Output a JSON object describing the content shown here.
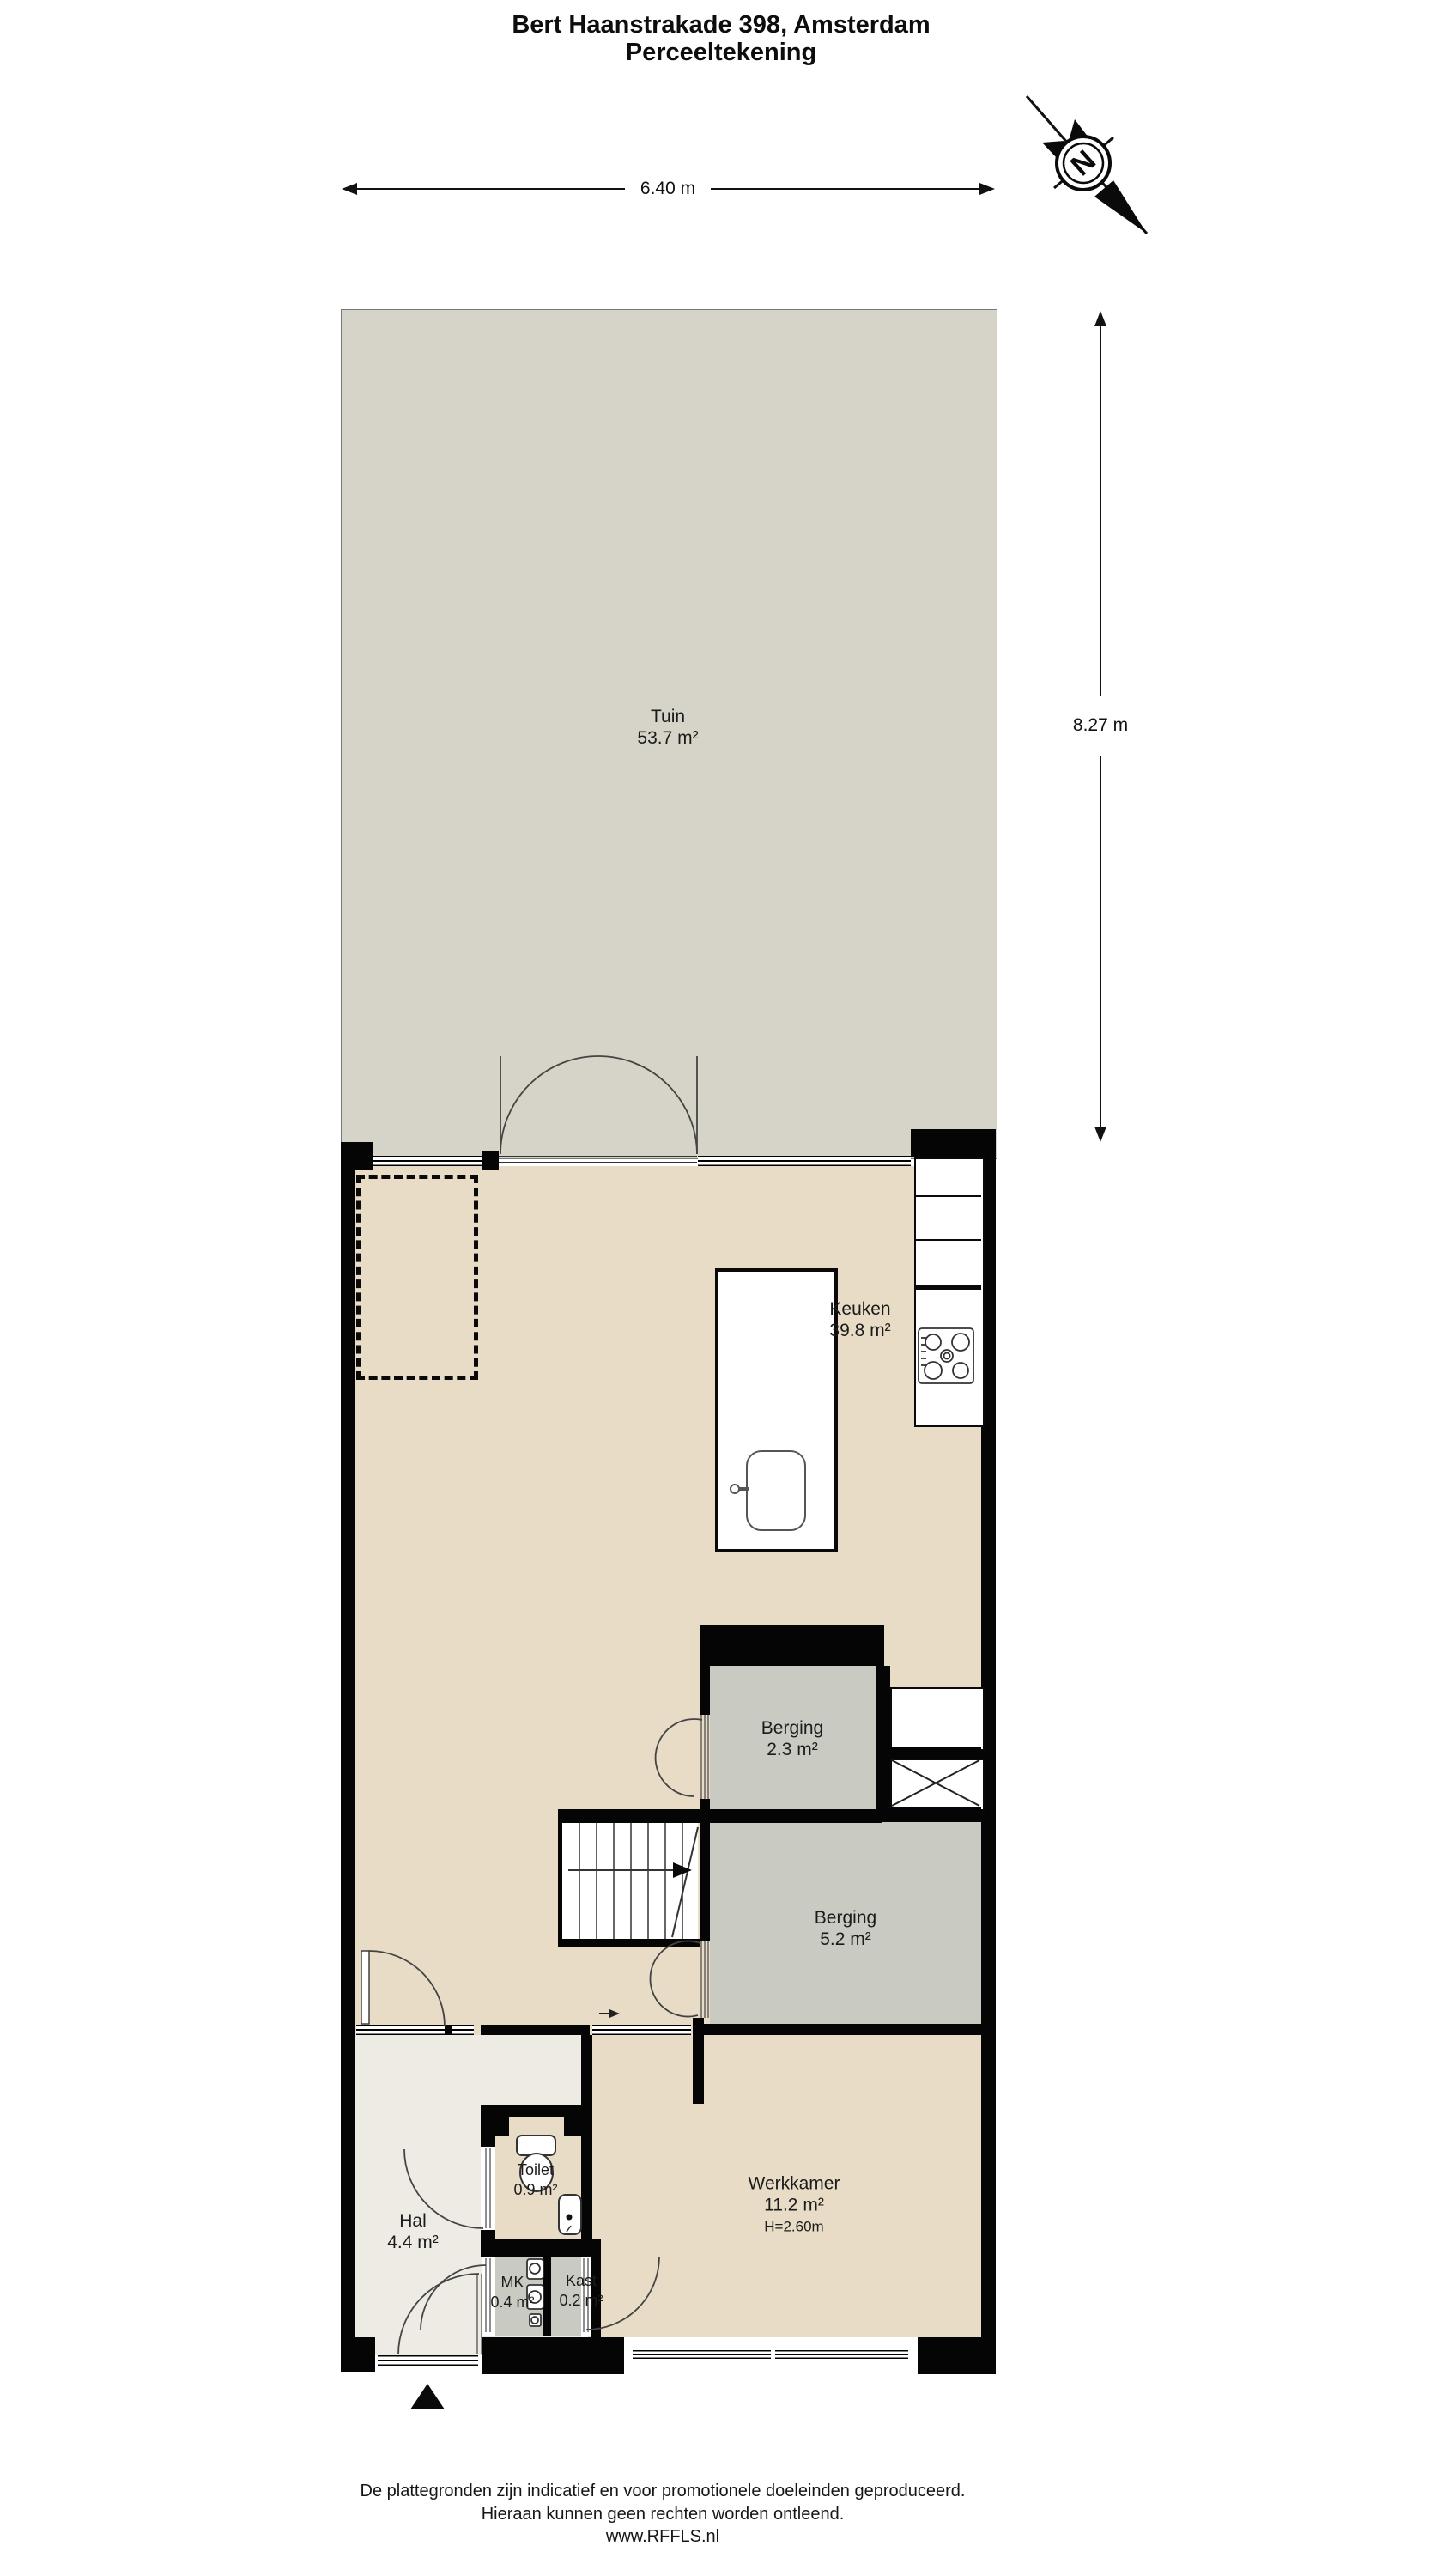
{
  "title": {
    "line1": "Bert Haanstrakade 398, Amsterdam",
    "line2": "Perceeltekening"
  },
  "dimensions": {
    "width_label": "6.40 m",
    "height_label": "8.27 m"
  },
  "compass": {
    "letter": "N"
  },
  "rooms": [
    {
      "id": "tuin",
      "name": "Tuin",
      "area": "53.7 m²"
    },
    {
      "id": "keuken",
      "name": "Keuken",
      "area": "39.8 m²"
    },
    {
      "id": "berging-23",
      "name": "Berging",
      "area": "2.3 m²"
    },
    {
      "id": "berging-52",
      "name": "Berging",
      "area": "5.2 m²"
    },
    {
      "id": "werkkamer",
      "name": "Werkkamer",
      "area": "11.2 m²",
      "height": "H=2.60m"
    },
    {
      "id": "hal",
      "name": "Hal",
      "area": "4.4 m²"
    },
    {
      "id": "toilet",
      "name": "Toilet",
      "area": "0.9 m²"
    },
    {
      "id": "mk",
      "name": "MK",
      "area": "0.4 m²"
    },
    {
      "id": "kast",
      "name": "Kast",
      "area": "0.2 m²"
    }
  ],
  "footer": {
    "line1": "De plattegronden zijn indicatief en voor promotionele doeleinden geproduceerd.",
    "line2": "Hieraan kunnen geen rechten worden ontleend.",
    "line3": "www.RFFLS.nl"
  },
  "colors": {
    "floor": "#e8dcc6",
    "garden": "#d6d3c8",
    "storage": "#c9cbc3",
    "hall": "#edebe3",
    "wall": "#050505"
  }
}
